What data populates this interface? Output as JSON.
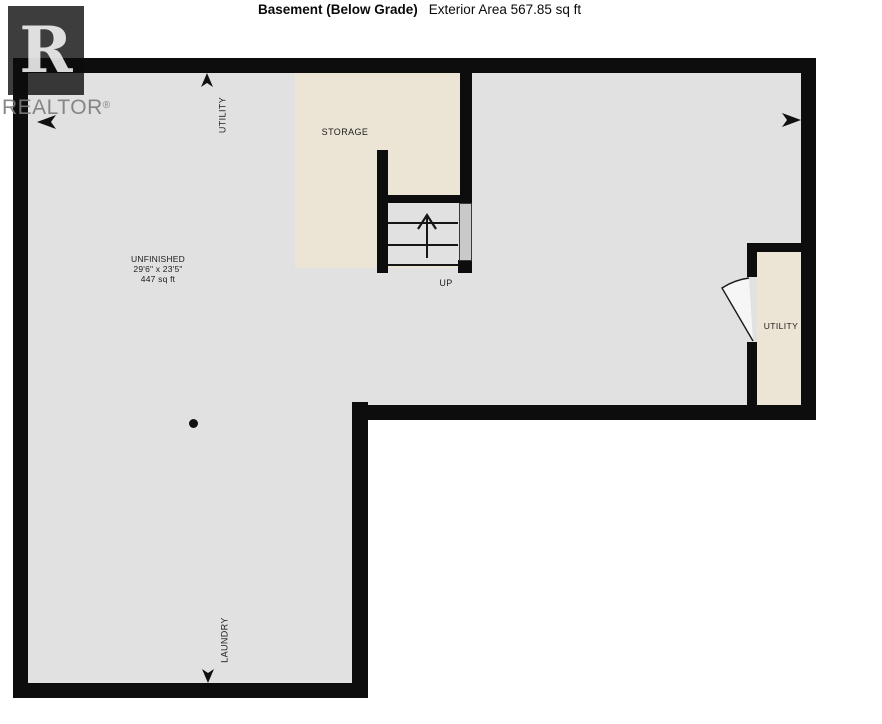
{
  "title": {
    "name": "Basement (Below Grade)",
    "exterior_area": "Exterior Area 567.85 sq ft"
  },
  "watermark": {
    "letter": "R",
    "brand": "REALTOR",
    "registered": "®"
  },
  "labels": {
    "utility_top": "UTILITY",
    "storage": "STORAGE",
    "unfinished_name": "UNFINISHED",
    "unfinished_dims": "29'6\" x 23'5\"",
    "unfinished_area": "447 sq ft",
    "stairs_up": "UP",
    "utility_right": "UTILITY",
    "laundry": "LAUNDRY"
  },
  "colors": {
    "wall": "#0d0d0d",
    "floor": "#e1e1e1",
    "storage_fill": "#ece4d4",
    "railing": "#c9c9c9",
    "label_text": "#1c1c1c",
    "watermark_gray": "#9a9a9a"
  }
}
